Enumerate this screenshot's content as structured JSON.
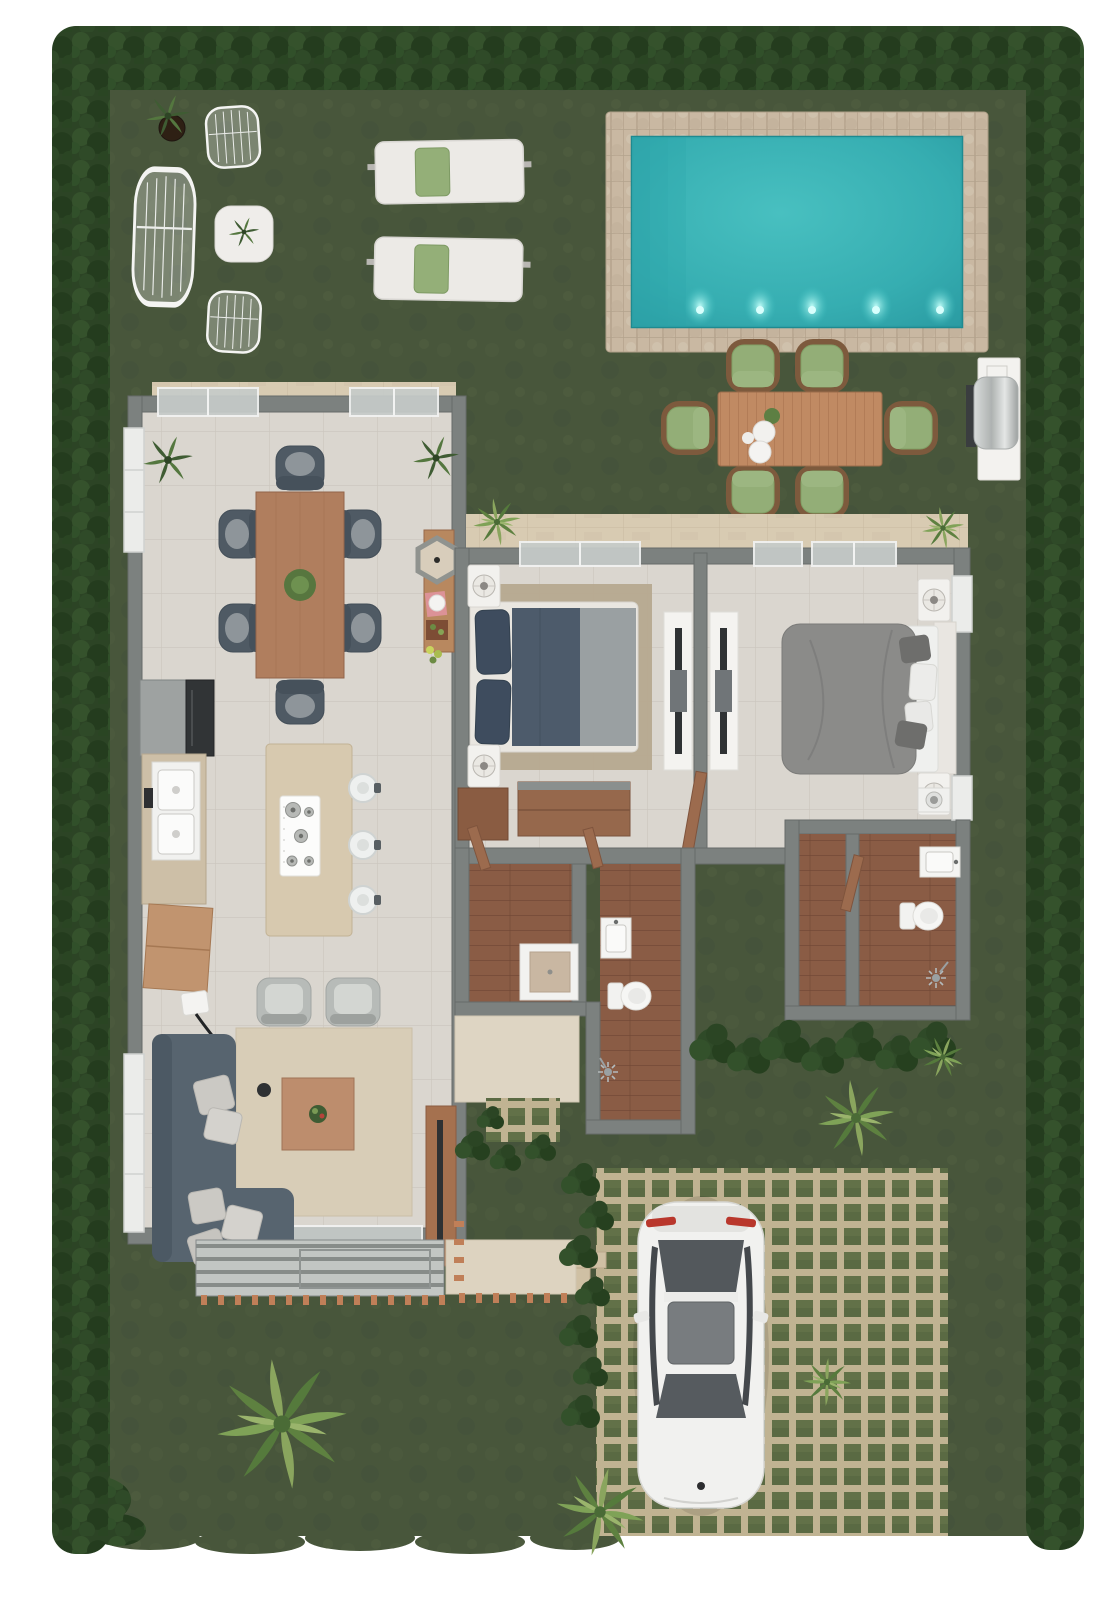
{
  "scene": {
    "type": "3d-floor-plan-render",
    "description": "Top-down 3D architectural rendering of a single-storey villa plot with lawn, hedge border, swimming pool, outdoor lounge and dining areas, BBQ, two-bedroom house and grass-paver driveway with a white car",
    "garden": {
      "hedge_sides": [
        "top",
        "left",
        "right",
        "bottom-left-corner"
      ],
      "lounge_set": {
        "wire_chairs": 2,
        "wire_sofa": 1,
        "marble_coffee_table": 1,
        "potted_plant": 1
      },
      "sun_loungers": {
        "count": 2,
        "pillow_color": "green"
      },
      "pool": {
        "shape": "rectangular",
        "deck": "stone tile",
        "steps": true,
        "underwater_lights": 5
      },
      "outdoor_dining": {
        "seats": 6,
        "cushion_color": "green",
        "tableware": "white plates + plant"
      },
      "bbq_grill": 1,
      "palm_trees": 7,
      "shrub_beds": 3,
      "paver_patch": 1,
      "step_pads": 1
    },
    "house": {
      "living_dining_kitchen": {
        "entry_terrace": "travertine strip with two sliding glass doors",
        "dining_seats": 6,
        "island_stools": 3,
        "armchairs": 2,
        "sofa": "L-shaped sectional with light pillows",
        "coffee_table": 1,
        "tv_console": 1,
        "console_with_hex_mirror": 1,
        "fridge": 1,
        "double_sink": 1,
        "cooktop_burners": 5,
        "floor_lamp": 1,
        "rear_deck": "slatted pergola deck with copper joists"
      },
      "bedroom_1": {
        "bed": "double, navy/grey duvet",
        "nightstands": 2,
        "dresser": 1,
        "closet": 1,
        "tv": 1,
        "rug": 1
      },
      "bedroom_2": {
        "bed": "double, grey duvet",
        "nightstands": 2,
        "tv": 1,
        "washer": 1
      },
      "bathroom_1": {
        "sink": 1,
        "toilet": 1,
        "shower": 1,
        "shower_tray": 1,
        "floor": "wood planks"
      },
      "bathroom_2": {
        "sink": 1,
        "toilet": 1,
        "shower": 1,
        "walk_in_corridor": 1,
        "floor": "wood planks"
      }
    },
    "driveway": {
      "surface": "grass pavers",
      "cars": 1,
      "car_color": "white",
      "car_orientation": "rear at top"
    }
  },
  "colors": {
    "background": "#ffffff",
    "grass": "#48563b",
    "hedge": "#2c4425",
    "pool_water": "#39b3b5",
    "pool_deck": "#c9b8a2",
    "pool_light": "#c2fef9",
    "floor_tile": "#dad6cf",
    "travertine": "#d8cbb2",
    "wall": "#7c817f",
    "wood": "#9c6b4e",
    "bathroom_floor": "#8a5c45",
    "sofa": "#57646f",
    "chair_dark": "#4f5a64",
    "rug_living": "#d8cdb7",
    "rug_bedroom": "#b6a98f",
    "bed1_duvet": "#4d5b6b",
    "bed2_duvet": "#8b8b89",
    "island": "#d7c9af",
    "cushion_green": "#93ae77",
    "paver": "#c0b392",
    "paver_grass": "#5a6a43",
    "copper": "#c07f58",
    "car_body": "#f1f1ef",
    "car_glass": "#53585c",
    "car_taillight": "#b9372c",
    "white_furniture": "#f2f1ee"
  }
}
